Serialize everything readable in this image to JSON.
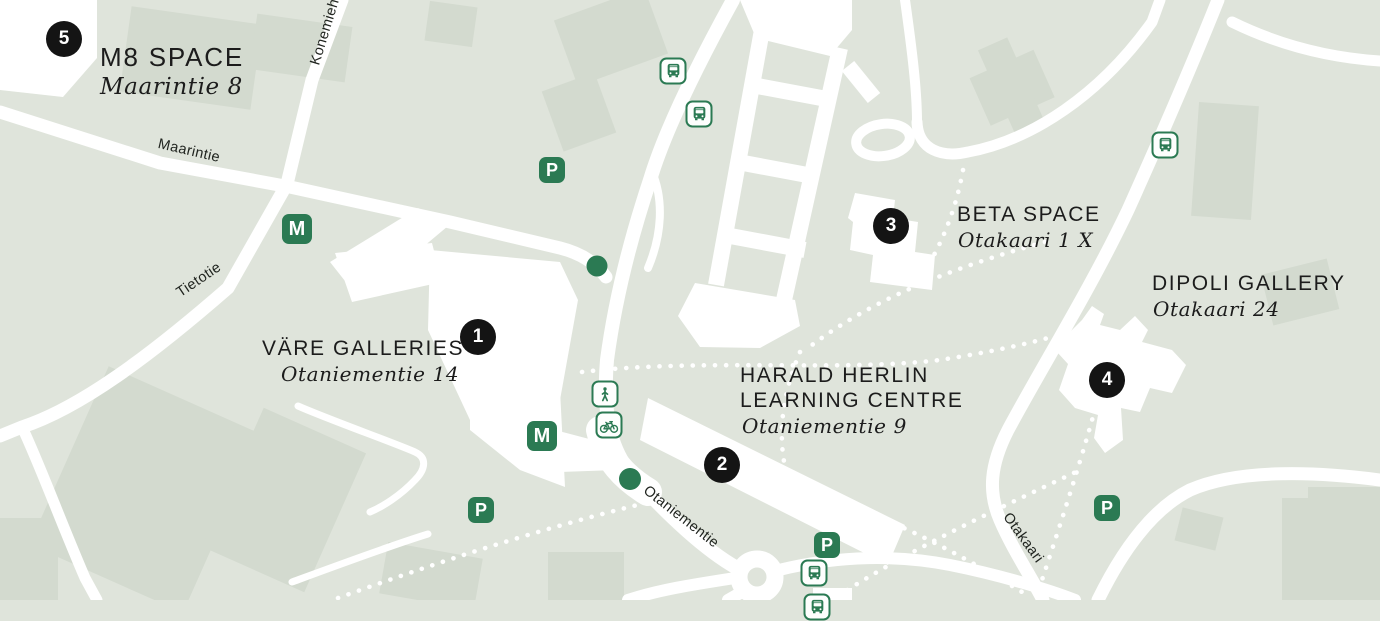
{
  "map": {
    "colors": {
      "background": "#dfe4db",
      "building_shade": "#d3dacf",
      "road": "#ffffff",
      "accent_green": "#2b7a53",
      "marker_black": "#141414",
      "text": "#1c1c1c"
    },
    "locations": [
      {
        "number": "1",
        "name_lines": [
          "VÄRE GALLERIES"
        ],
        "address": "Otaniementie 14",
        "marker": {
          "x": 478,
          "y": 337
        },
        "label": {
          "x": 262,
          "y": 336,
          "address_dx": 19
        },
        "size": "normal"
      },
      {
        "number": "2",
        "name_lines": [
          "HARALD HERLIN",
          "LEARNING CENTRE"
        ],
        "address": "Otaniementie 9",
        "marker": {
          "x": 722,
          "y": 465
        },
        "label": {
          "x": 740,
          "y": 363,
          "address_dx": 2
        },
        "size": "normal"
      },
      {
        "number": "3",
        "name_lines": [
          "BETA SPACE"
        ],
        "address": "Otakaari 1 X",
        "marker": {
          "x": 891,
          "y": 226
        },
        "label": {
          "x": 957,
          "y": 202,
          "address_dx": 1
        },
        "size": "normal"
      },
      {
        "number": "4",
        "name_lines": [
          "DIPOLI GALLERY"
        ],
        "address": "Otakaari 24",
        "marker": {
          "x": 1107,
          "y": 380
        },
        "label": {
          "x": 1152,
          "y": 271,
          "address_dx": 1
        },
        "size": "normal"
      },
      {
        "number": "5",
        "name_lines": [
          "M8 SPACE"
        ],
        "address": "Maarintie 8",
        "marker": {
          "x": 64,
          "y": 39
        },
        "label": {
          "x": 100,
          "y": 42,
          "address_dx": 0
        },
        "size": "large"
      }
    ],
    "streets": [
      {
        "name": "Maarintie",
        "x": 189,
        "y": 151,
        "angle": 13
      },
      {
        "name": "Konemiehentie",
        "x": 330,
        "y": 16,
        "angle": -73
      },
      {
        "name": "Tietotie",
        "x": 199,
        "y": 280,
        "angle": -34
      },
      {
        "name": "Otaniementie",
        "x": 681,
        "y": 517,
        "angle": 38
      },
      {
        "name": "Otakaari",
        "x": 1023,
        "y": 538,
        "angle": 54
      }
    ],
    "transit": {
      "metro_letter": "M",
      "parking_letter": "P",
      "metro": [
        {
          "x": 297,
          "y": 229
        },
        {
          "x": 542,
          "y": 436
        }
      ],
      "parking": [
        {
          "x": 552,
          "y": 170
        },
        {
          "x": 481,
          "y": 510
        },
        {
          "x": 827,
          "y": 545
        },
        {
          "x": 1107,
          "y": 508
        }
      ],
      "bus": [
        {
          "x": 673,
          "y": 71
        },
        {
          "x": 699,
          "y": 114
        },
        {
          "x": 1165,
          "y": 145
        },
        {
          "x": 814,
          "y": 573
        },
        {
          "x": 817,
          "y": 607
        }
      ],
      "pedestrian": [
        {
          "x": 605,
          "y": 394
        }
      ],
      "bicycle": [
        {
          "x": 609,
          "y": 425
        }
      ]
    }
  }
}
